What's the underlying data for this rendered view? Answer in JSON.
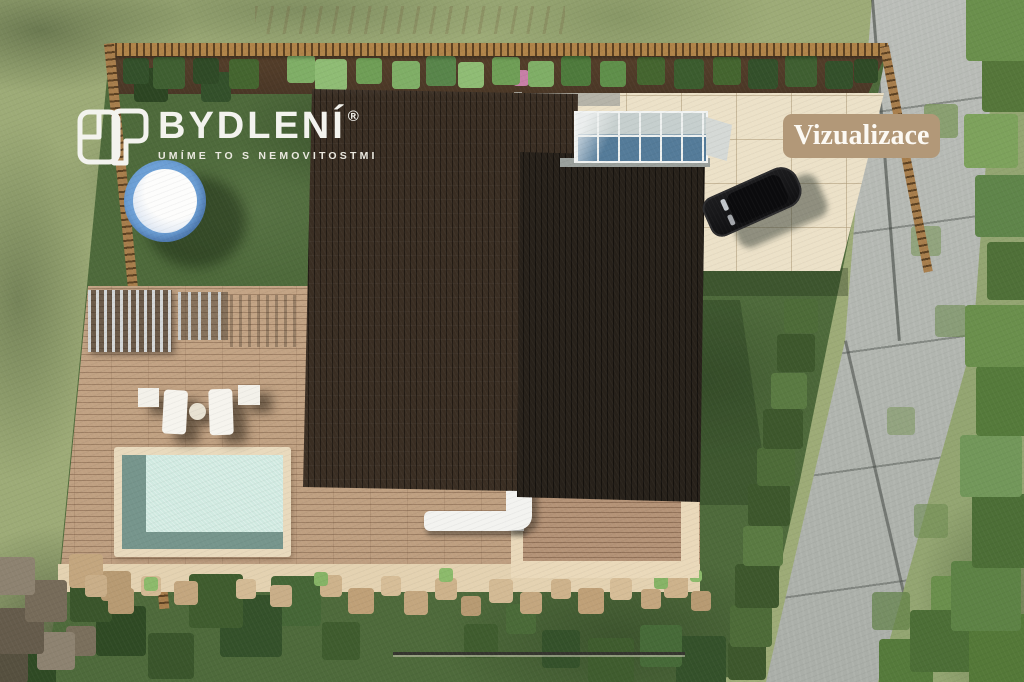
{
  "watermarks": {
    "logo": {
      "brand": "BYDLENÍ",
      "registered_mark": "®",
      "tagline": "UMÍME TO S NEMOVITOSTMI",
      "text_color": "#f3f3ee"
    },
    "badge": {
      "label": "Vizualizace",
      "background": "#b29878",
      "text_color": "#fcf9f3"
    }
  },
  "scene": {
    "type": "aerial-architectural-visualization",
    "palette": {
      "outside_grass": "#9dab77",
      "inside_lawn": "#4e6a3b",
      "deck_wood": "#c7a586",
      "roof_main": "#352b21",
      "roof_secondary": "#26211a",
      "driveway_pavers": "#ece1c8",
      "sidewalk_concrete": "#b5b8b3",
      "pool_water": "#cfe9e0",
      "pool_edge": "#76958c",
      "pool_frame": "#e9dabd",
      "hot_tub_ring": "#6da0d6",
      "fence_wood": "#a87e4c",
      "rock_garden": "#cdb28d",
      "car_body": "#141414",
      "atrium_glass": "#547b99"
    },
    "objects": [
      "fence",
      "flower-bed",
      "lawn",
      "hot-tub",
      "pergola",
      "sun-loungers",
      "wooden-deck",
      "swimming-pool",
      "house-roof",
      "glass-atrium",
      "driveway",
      "car",
      "rock-garden",
      "shrub-row",
      "sidewalk",
      "trees"
    ]
  }
}
